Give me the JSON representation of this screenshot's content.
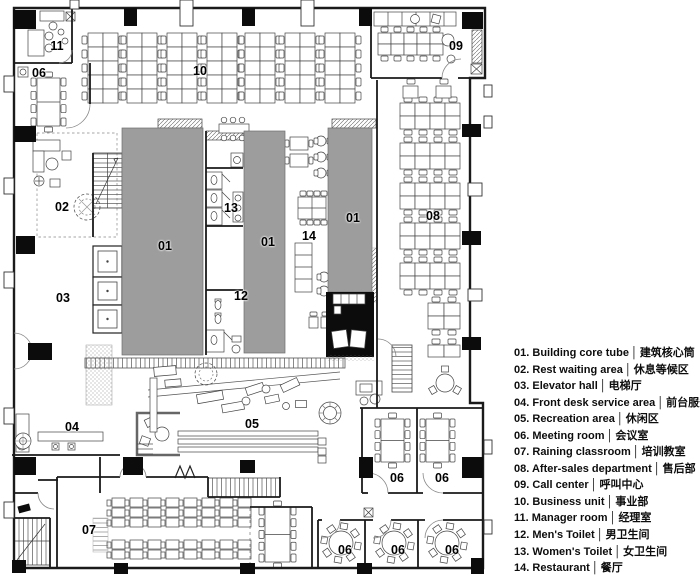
{
  "colors": {
    "core_gray": "#9d9d9d",
    "wall": "#1a1a1a",
    "label": "#000000",
    "black_fill": "#0c0c0c"
  },
  "legend": {
    "separator": "│",
    "items": [
      {
        "num": "01",
        "en": "Building core tube",
        "zh": "建筑核心筒"
      },
      {
        "num": "02",
        "en": "Rest waiting area",
        "zh": "休息等候区"
      },
      {
        "num": "03",
        "en": "Elevator hall",
        "zh": "电梯厅"
      },
      {
        "num": "04",
        "en": "Front desk service area",
        "zh": "前台服务区"
      },
      {
        "num": "05",
        "en": "Recreation area",
        "zh": "休闲区"
      },
      {
        "num": "06",
        "en": "Meeting room",
        "zh": "会议室"
      },
      {
        "num": "07",
        "en": "Raining classroom",
        "zh": "培训教室"
      },
      {
        "num": "08",
        "en": "After-sales department",
        "zh": "售后部"
      },
      {
        "num": "09",
        "en": "Call center",
        "zh": "呼叫中心"
      },
      {
        "num": "10",
        "en": "Business unit",
        "zh": "事业部"
      },
      {
        "num": "11",
        "en": "Manager room",
        "zh": "经理室"
      },
      {
        "num": "12",
        "en": "Men's Toilet",
        "zh": "男卫生间"
      },
      {
        "num": "13",
        "en": "Women's Toilet",
        "zh": "女卫生间"
      },
      {
        "num": "14",
        "en": "Restaurant",
        "zh": "餐厅"
      }
    ]
  },
  "plan_labels": [
    {
      "text": "11",
      "x": 57,
      "y": 46
    },
    {
      "text": "06",
      "x": 39,
      "y": 73
    },
    {
      "text": "10",
      "x": 200,
      "y": 71
    },
    {
      "text": "09",
      "x": 456,
      "y": 46
    },
    {
      "text": "02",
      "x": 62,
      "y": 207
    },
    {
      "text": "03",
      "x": 63,
      "y": 298
    },
    {
      "text": "01",
      "x": 165,
      "y": 246
    },
    {
      "text": "01",
      "x": 268,
      "y": 242
    },
    {
      "text": "01",
      "x": 353,
      "y": 218
    },
    {
      "text": "13",
      "x": 231,
      "y": 208
    },
    {
      "text": "14",
      "x": 309,
      "y": 236
    },
    {
      "text": "12",
      "x": 241,
      "y": 296
    },
    {
      "text": "08",
      "x": 433,
      "y": 216
    },
    {
      "text": "04",
      "x": 72,
      "y": 427
    },
    {
      "text": "05",
      "x": 252,
      "y": 424
    },
    {
      "text": "06",
      "x": 397,
      "y": 478
    },
    {
      "text": "06",
      "x": 442,
      "y": 478
    },
    {
      "text": "07",
      "x": 89,
      "y": 530
    },
    {
      "text": "06",
      "x": 345,
      "y": 550
    },
    {
      "text": "06",
      "x": 398,
      "y": 550
    },
    {
      "text": "06",
      "x": 452,
      "y": 550
    }
  ]
}
